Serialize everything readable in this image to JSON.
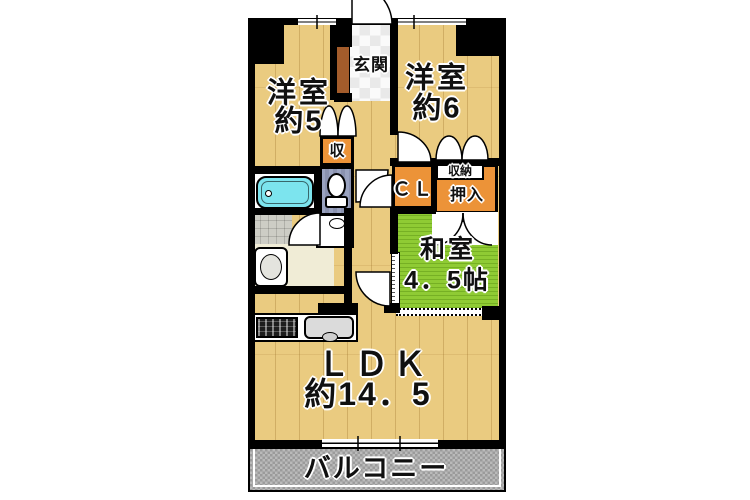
{
  "colors": {
    "wall": "#000000",
    "floor_wood": "#EACB80",
    "tatami_green": "#8FCB34",
    "closet_orange": "#EC9338",
    "bathtub_cyan": "#7CE4EE",
    "toilet_wall_blue": "#929BB8",
    "tile_gray": "#CDCDC5",
    "washroom_cream": "#F0ECD6",
    "balcony_gray": "#ADADAD",
    "entrance_step_brown": "#A35C2B",
    "background": "#FFFFFF"
  },
  "rooms": {
    "western_room_5": {
      "name_line1": "洋室",
      "name_line2": "約5"
    },
    "western_room_6": {
      "name_line1": "洋室",
      "name_line2": "約6"
    },
    "entrance": {
      "name": "玄関"
    },
    "storage_shu": {
      "name": "収"
    },
    "closet_cl": {
      "name": "ＣＬ"
    },
    "storage_shuno": {
      "name": "収納"
    },
    "oshiire": {
      "name": "押入"
    },
    "japanese_room": {
      "name_line1": "和室",
      "name_line2": "4．5帖"
    },
    "ldk": {
      "name_line1": "ＬＤＫ",
      "name_line2": "約14．5"
    },
    "balcony": {
      "name": "バルコニー"
    }
  }
}
